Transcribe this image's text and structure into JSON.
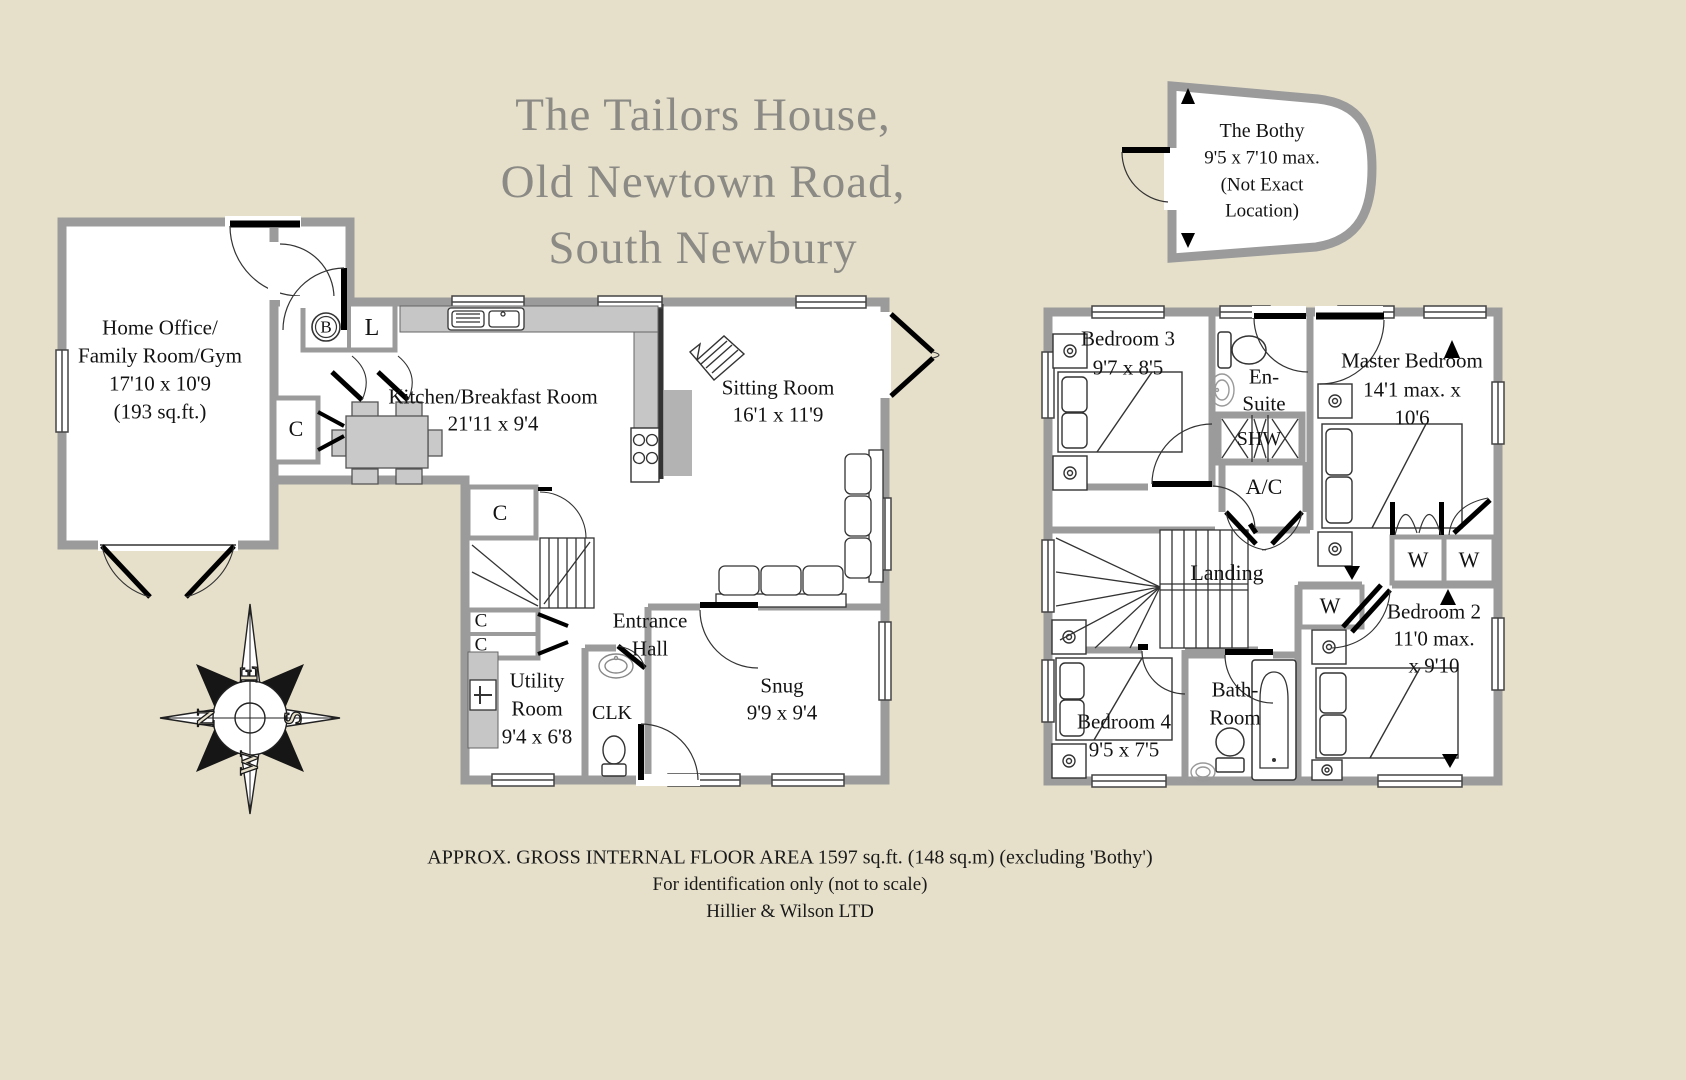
{
  "title": {
    "line1": "The Tailors House,",
    "line2": "Old Newtown Road,",
    "line3": "South Newbury"
  },
  "bothy": {
    "name": "The Bothy",
    "dims": "9'5 x 7'10 max.",
    "note1": "(Not Exact",
    "note2": "Location)"
  },
  "ground_floor": {
    "home_office": {
      "l1": "Home Office/",
      "l2": "Family Room/Gym",
      "l3": "17'10 x 10'9",
      "l4": "(193 sq.ft.)"
    },
    "kitchen": {
      "l1": "Kitchen/Breakfast Room",
      "l2": "21'11 x 9'4"
    },
    "sitting_room": {
      "l1": "Sitting Room",
      "l2": "16'1 x 11'9"
    },
    "entrance_hall": {
      "l1": "Entrance",
      "l2": "Hall"
    },
    "utility": {
      "l1": "Utility",
      "l2": "Room",
      "l3": "9'4 x 6'8"
    },
    "clk": "CLK",
    "snug": {
      "l1": "Snug",
      "l2": "9'9 x 9'4"
    },
    "boiler": "B",
    "larder": "L",
    "cupboard": "C"
  },
  "first_floor": {
    "bedroom3": {
      "l1": "Bedroom 3",
      "l2": "9'7 x 8'5"
    },
    "ensuite": {
      "l1": "En-",
      "l2": "Suite"
    },
    "shower": "SHW",
    "airing": "A/C",
    "master": {
      "l1": "Master Bedroom",
      "l2": "14'1 max. x",
      "l3": "10'6"
    },
    "landing": "Landing",
    "wardrobe": "W",
    "bedroom2": {
      "l1": "Bedroom 2",
      "l2": "11'0 max.",
      "l3": "x 9'10"
    },
    "bathroom": {
      "l1": "Bath-",
      "l2": "Room"
    },
    "bedroom4": {
      "l1": "Bedroom 4",
      "l2": "9'5 x 7'5"
    }
  },
  "compass": {
    "n": "N",
    "e": "E",
    "s": "S",
    "w": "W"
  },
  "footer": {
    "line1": "APPROX. GROSS INTERNAL FLOOR AREA 1597 sq.ft. (148 sq.m) (excluding 'Bothy')",
    "line2": "For identification only (not to scale)",
    "line3": "Hillier & Wilson LTD"
  },
  "colors": {
    "background": "#e6e0cb",
    "wall": "#9b9b9b",
    "counter": "#c6c6c6",
    "title_gray": "#8b8a84",
    "ink": "#131313"
  }
}
